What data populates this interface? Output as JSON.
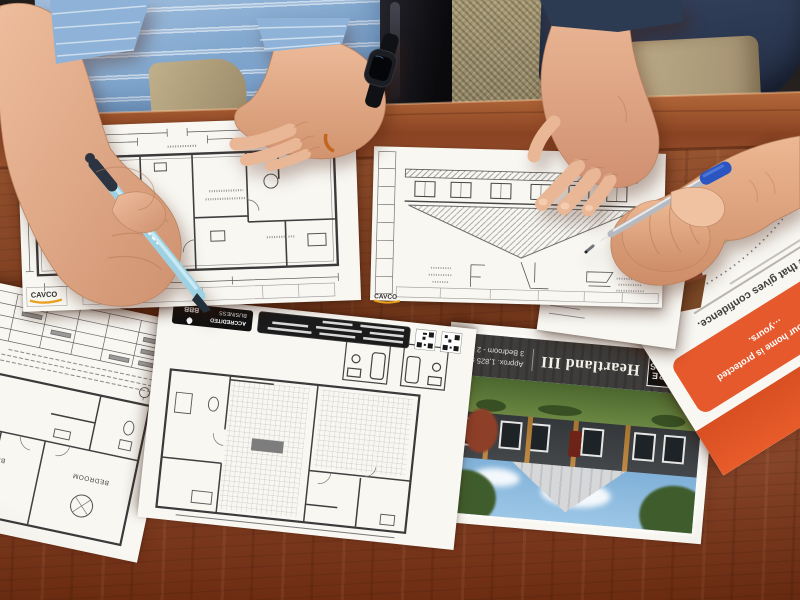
{
  "meta": {
    "description": "Photograph of two people reviewing manufactured-home floor plans and brochures on a cherry wood desk"
  },
  "palette": {
    "desk_wood": "#8a4928",
    "polo_blue": "#8fb3d8",
    "navy_shirt": "#2c3a52",
    "khaki": "#bcab87",
    "paper_white": "#f8f7f2",
    "brochure_orange": "#e6592c",
    "pen_light_blue": "#9ed2e2",
    "pen_cap_blue": "#2b55c0",
    "logo_yellow": "#e8a21f",
    "skin": "#e4ad89"
  },
  "heartland_brochure": {
    "brand_line1": "FUTURE",
    "brand_line2": "HOMES",
    "model": "Heartland III",
    "spec_area": "Approx. 1,825 sq ft",
    "spec_rooms": "3 Bedroom - 2 Bath"
  },
  "insurance_brochure": {
    "headline": "…rage that gives confidence.",
    "box_line1": "…ing your home is protected",
    "box_line2": "…yours."
  },
  "blueprints": {
    "top_left": {
      "logo": "CAVCO"
    },
    "top_right": {
      "logo": "CAVCO"
    },
    "bottom_middle": {
      "badge_line1": "ACCREDITED",
      "badge_line2": "BUSINESS",
      "badge_brand": "BBB"
    },
    "left_sheet": {
      "room_label_1": "BEDROOM",
      "room_label_2": "BEDROOM"
    }
  }
}
